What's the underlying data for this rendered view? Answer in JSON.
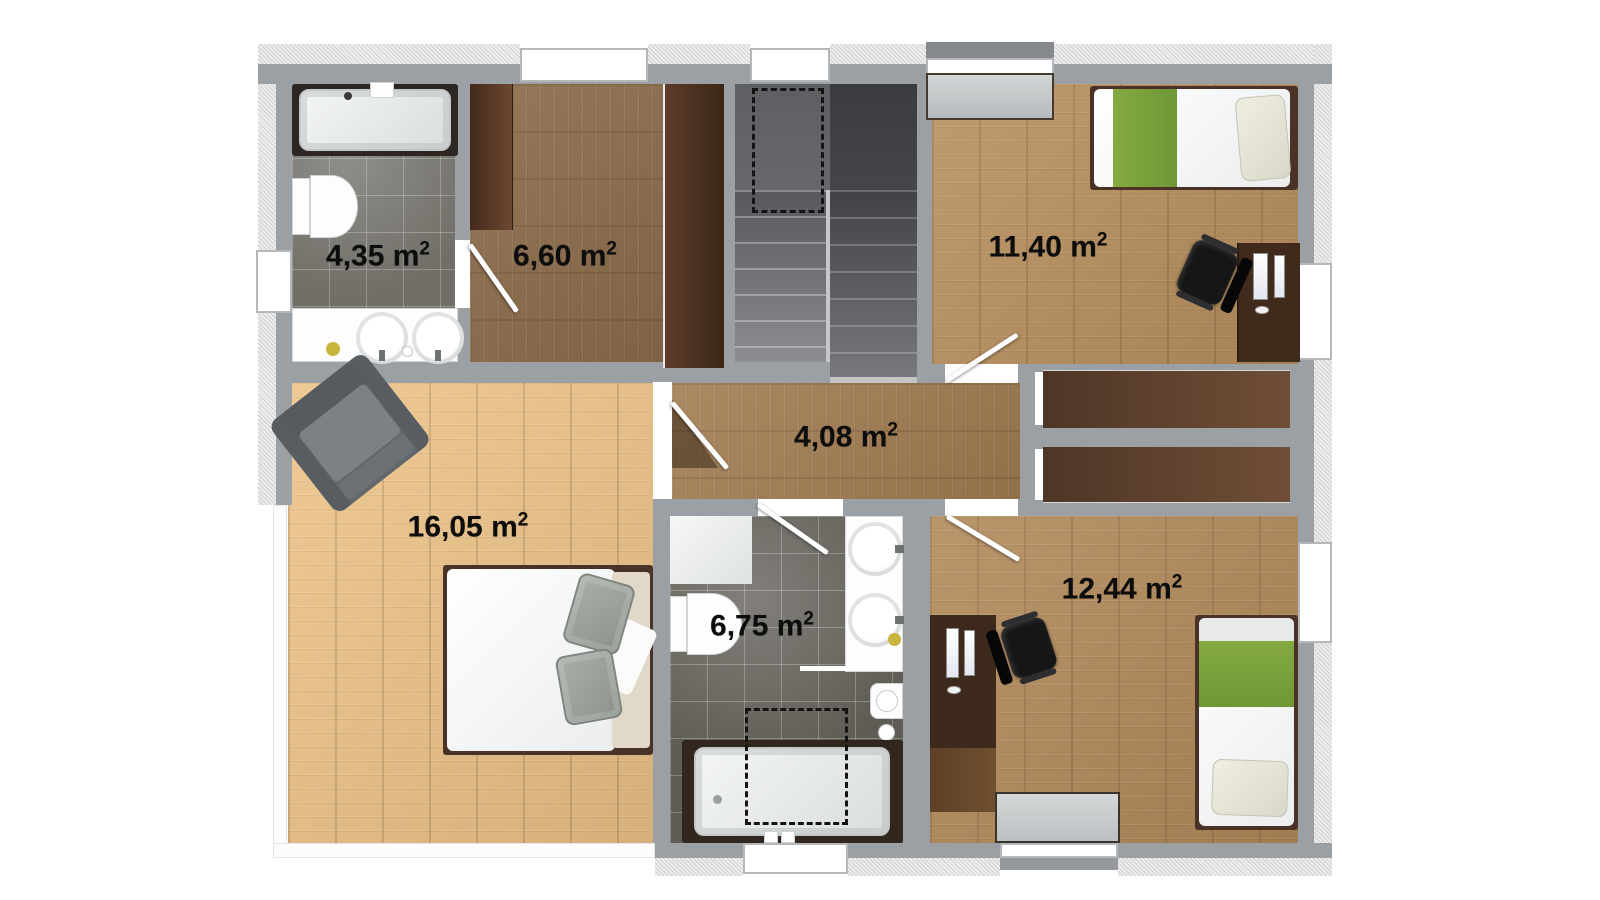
{
  "plan": {
    "title": "upper-floor-plan",
    "rooms": [
      {
        "id": "bathroom-top-left",
        "label": "4,35 m",
        "sup": "2"
      },
      {
        "id": "dressing-room",
        "label": "6,60 m",
        "sup": "2"
      },
      {
        "id": "bedroom-top-right",
        "label": "11,40 m",
        "sup": "2"
      },
      {
        "id": "hallway",
        "label": "4,08 m",
        "sup": "2"
      },
      {
        "id": "bedroom-master",
        "label": "16,05 m",
        "sup": "2"
      },
      {
        "id": "bathroom-bottom",
        "label": "6,75 m",
        "sup": "2"
      },
      {
        "id": "bedroom-bottom-right",
        "label": "12,44 m",
        "sup": "2"
      }
    ],
    "colors": {
      "wall_gray": "#9aa0a4",
      "hatch_band": "#ededed",
      "wood_light": "#eec489",
      "wood_medium": "#a27d52",
      "wood_tan": "#b8905e",
      "wood_dark": "#8a6a48",
      "tile_light": "#716f68",
      "tile_dark": "#5f5c55",
      "furniture_brown": "#46301f",
      "bed_accent_green": "#7fa63e",
      "stair_dark": "#3d3f43",
      "stair_light": "#8e8f93"
    }
  }
}
